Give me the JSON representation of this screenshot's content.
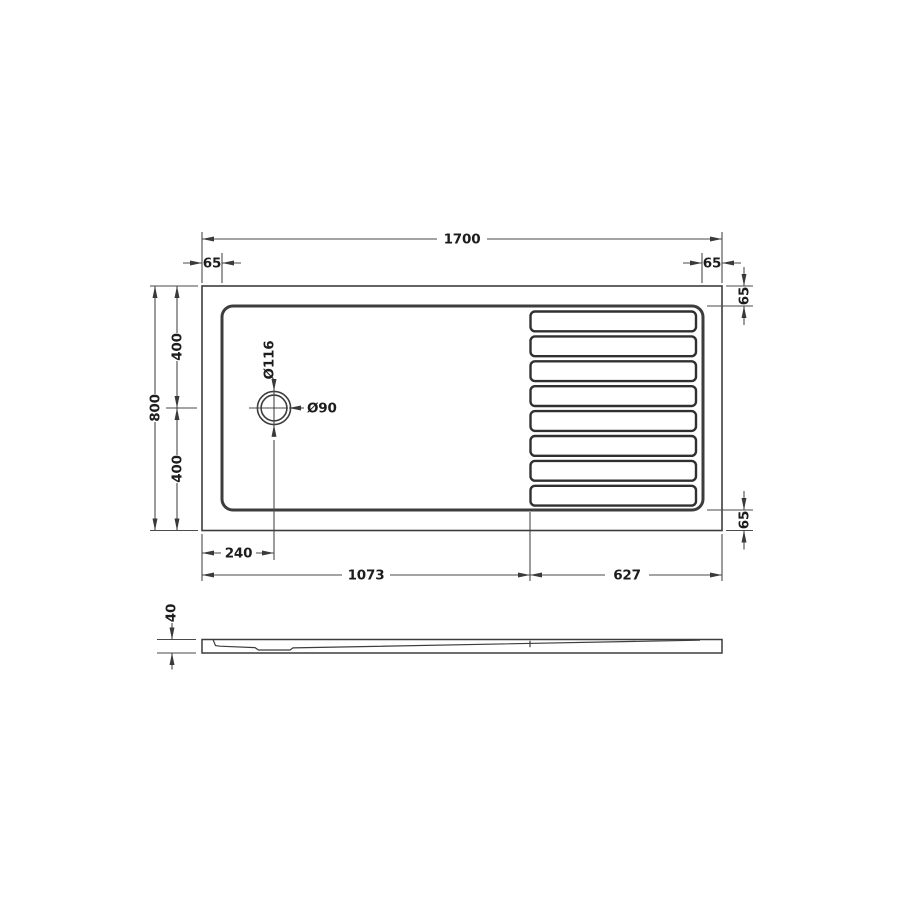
{
  "drawing": {
    "type": "technical-dimension-drawing",
    "subject": "walk-in rectangular shower tray",
    "colors": {
      "background": "#ffffff",
      "part_line": "#3d3d3d",
      "dimension_line": "#4a4a4a",
      "text": "#1d1d1d"
    },
    "top_view": {
      "dim_overall_width": "1700",
      "dim_overall_depth": "800",
      "dim_depth_upper": "400",
      "dim_depth_lower": "400",
      "dim_left_inset": "65",
      "dim_right_inset": "65",
      "dim_right_top_inset": "65",
      "dim_right_bottom_inset": "65",
      "drain_outer_diameter": "Ø116",
      "drain_inner_diameter": "Ø90",
      "dim_drain_offset": "240",
      "dim_flat_zone_length": "1073",
      "dim_ridged_zone_length": "627",
      "slat_count": 8
    },
    "side_view": {
      "dim_thickness": "40"
    }
  }
}
